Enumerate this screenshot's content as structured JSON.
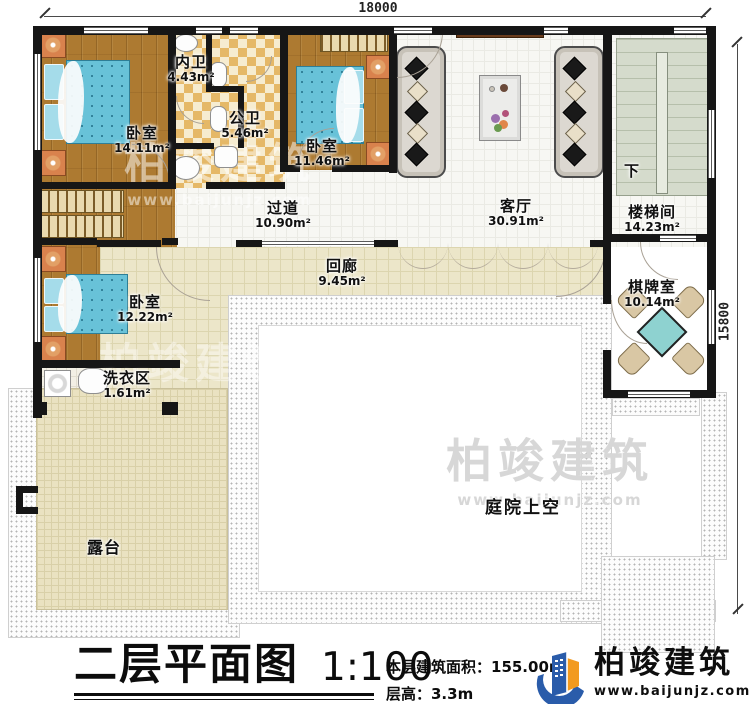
{
  "title_block": {
    "plan_title": "二层平面图",
    "scale": "1:100",
    "area_line": "本层建筑面积：155.00m²",
    "floor_height_line": "层高：3.3m"
  },
  "dimensions": {
    "top": "18000",
    "right": "15800"
  },
  "rooms": {
    "bedroom_a": {
      "name": "卧室",
      "area": "14.11m²"
    },
    "bath_inner": {
      "name": "内卫",
      "area": "4.43m²"
    },
    "bath_public": {
      "name": "公卫",
      "area": "5.46m²"
    },
    "bedroom_b": {
      "name": "卧室",
      "area": "11.46m²"
    },
    "living": {
      "name": "客厅",
      "area": "30.91m²"
    },
    "stairwell": {
      "name": "楼梯间",
      "area": "14.23m²",
      "direction": "下"
    },
    "hallway": {
      "name": "过道",
      "area": "10.90m²"
    },
    "corridor": {
      "name": "回廊",
      "area": "9.45m²"
    },
    "bedroom_c": {
      "name": "卧室",
      "area": "12.22m²"
    },
    "laundry": {
      "name": "洗衣区",
      "area": "1.61m²"
    },
    "chess": {
      "name": "棋牌室",
      "area": "10.14m²"
    },
    "terrace": {
      "name": "露台"
    },
    "courtyard": {
      "name": "庭院上空"
    }
  },
  "branding": {
    "company": "柏竣建筑",
    "website": "www.baijunjz.com"
  },
  "watermark": {
    "company": "柏竣建筑",
    "website": "www.baijunjz.com"
  },
  "colors": {
    "wall": "#161616",
    "accent_blue": "#2a5caa",
    "accent_orange": "#f29a1f",
    "bed": "#68c2d8",
    "stair": "#d5dbcc"
  }
}
